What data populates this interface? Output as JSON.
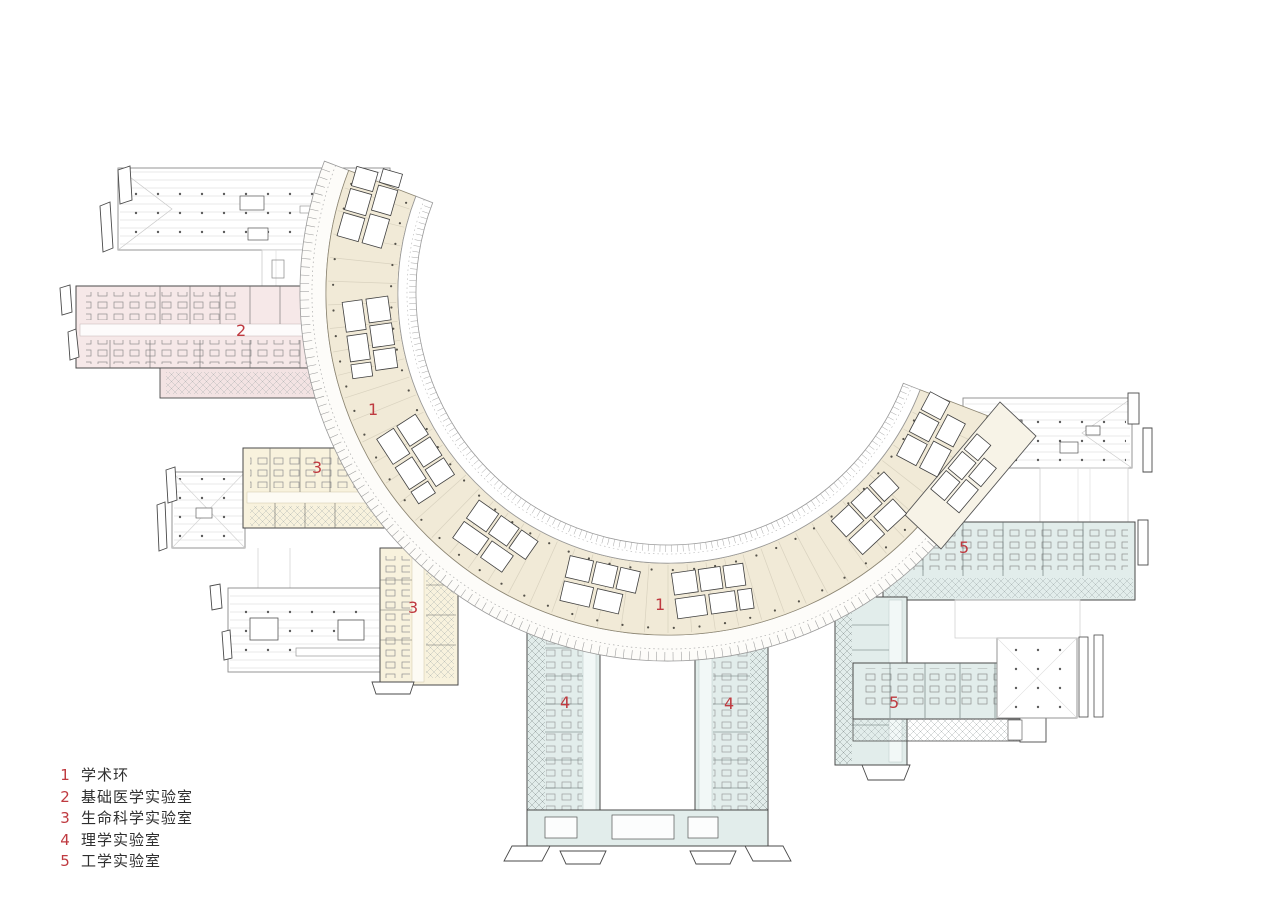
{
  "legend": {
    "items": [
      {
        "number": "1",
        "label": "学术环"
      },
      {
        "number": "2",
        "label": "基础医学实验室"
      },
      {
        "number": "3",
        "label": "生命科学实验室"
      },
      {
        "number": "4",
        "label": "理学实验室"
      },
      {
        "number": "5",
        "label": "工学实验室"
      }
    ]
  },
  "plan_labels": [
    {
      "number": "1",
      "area": "academic-ring-west"
    },
    {
      "number": "1",
      "area": "academic-ring-south"
    },
    {
      "number": "2",
      "area": "basic-medicine-lab"
    },
    {
      "number": "3",
      "area": "life-science-lab-north"
    },
    {
      "number": "3",
      "area": "life-science-lab-south"
    },
    {
      "number": "4",
      "area": "science-lab-west"
    },
    {
      "number": "4",
      "area": "science-lab-east"
    },
    {
      "number": "5",
      "area": "engineering-lab-north"
    },
    {
      "number": "5",
      "area": "engineering-lab-south"
    }
  ],
  "colors": {
    "label_red": "#bf3a40",
    "ring_cream": "#f1ead7",
    "wing2_pink": "#f6e8e8",
    "wing3_cream": "#f8f2dd",
    "wing45_blue": "#e2edeb",
    "hall_white": "#ffffff",
    "outline_dark": "#4a4a4a"
  }
}
